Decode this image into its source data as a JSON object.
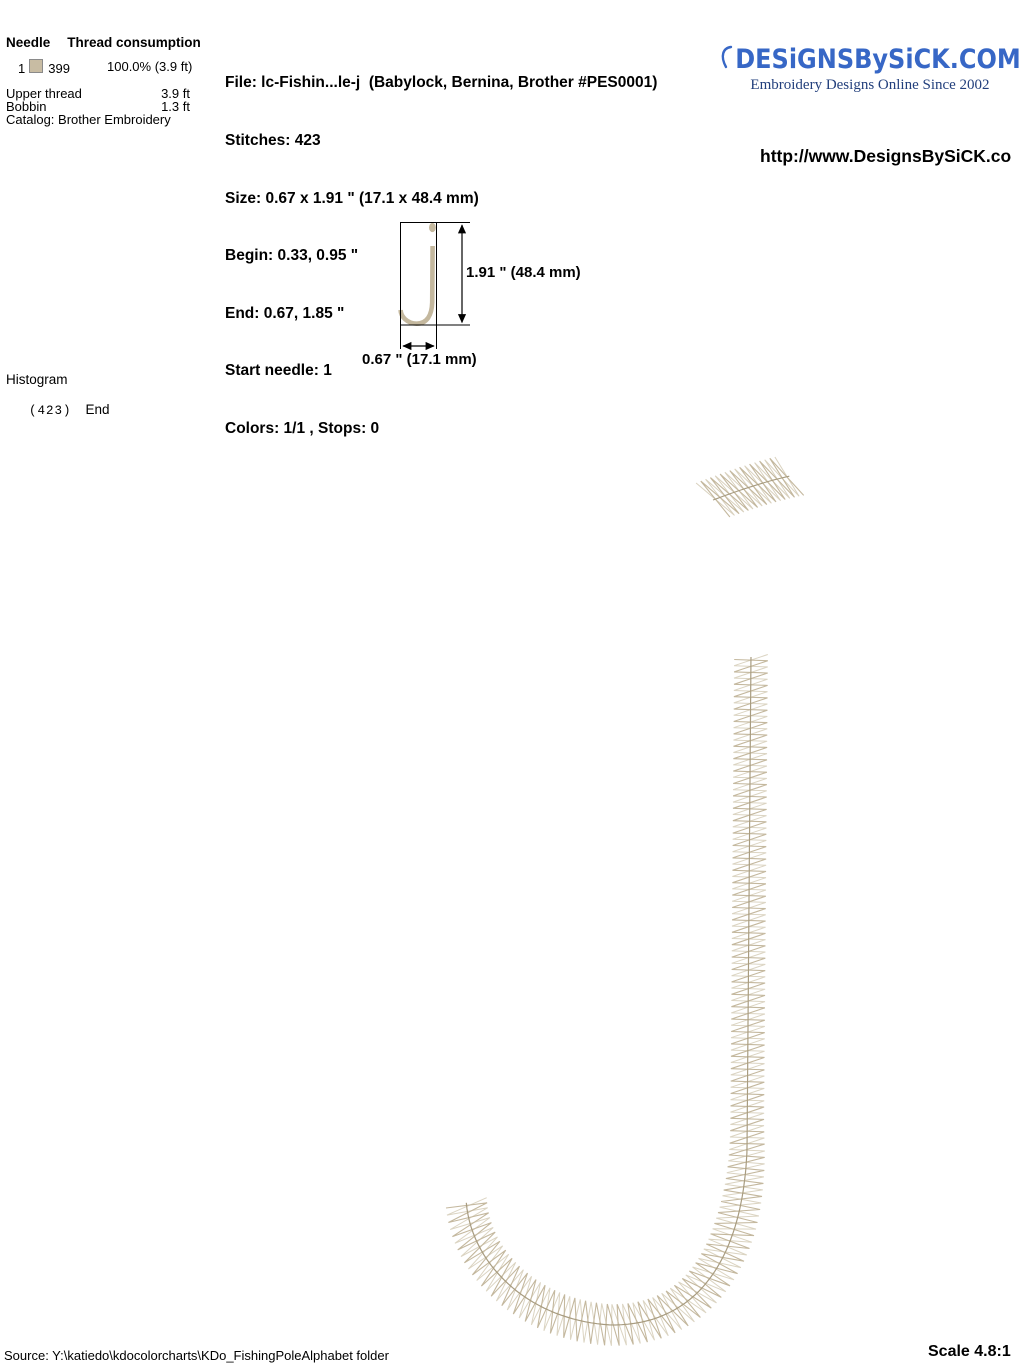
{
  "thread_table": {
    "header": {
      "needle": "Needle",
      "consumption": "Thread consumption"
    },
    "rows": [
      {
        "needle": "1",
        "swatch_color": "#c8bca3",
        "code": "399",
        "usage": "100.0% (3.9 ft)"
      }
    ],
    "upper_thread": {
      "label": "Upper thread",
      "value": "3.9 ft"
    },
    "bobbin": {
      "label": "Bobbin",
      "value": "1.3 ft"
    },
    "catalog": "Catalog: Brother Embroidery"
  },
  "file_info": {
    "file": "File: lc-Fishin...le-j  (Babylock, Bernina, Brother #PES0001)",
    "stitches": "Stitches: 423",
    "size": "Size: 0.67 x 1.91 \" (17.1 x 48.4 mm)",
    "begin": "Begin: 0.33, 0.95 \"",
    "end": "End: 0.67, 1.85 \"",
    "start_needle": "Start needle: 1",
    "colors": "Colors: 1/1 , Stops: 0"
  },
  "brand": {
    "logo": "DESiGNSBySiCK.COM",
    "tagline": "Embroidery Designs Online Since 2002",
    "url": "http://www.DesignsBySiCK.co",
    "logo_color": "#3767c6",
    "tagline_color": "#223f7c"
  },
  "preview": {
    "height_label": "1.91 \" (48.4 mm)",
    "width_label": "0.67 \" (17.1 mm)"
  },
  "histogram": {
    "title": "Histogram",
    "stitch_count": "(423)",
    "end_label": "End"
  },
  "footer": {
    "source": "Source: Y:\\katiedo\\kdocolorcharts\\KDo_FishingPoleAlphabet folder",
    "scale": "Scale 4.8:1"
  },
  "design": {
    "letter": "j",
    "thread_color": "#c4b89e",
    "thread_color_light": "#cfc5ae",
    "spine_color": "#a89c80",
    "outline_color": "#000000"
  }
}
